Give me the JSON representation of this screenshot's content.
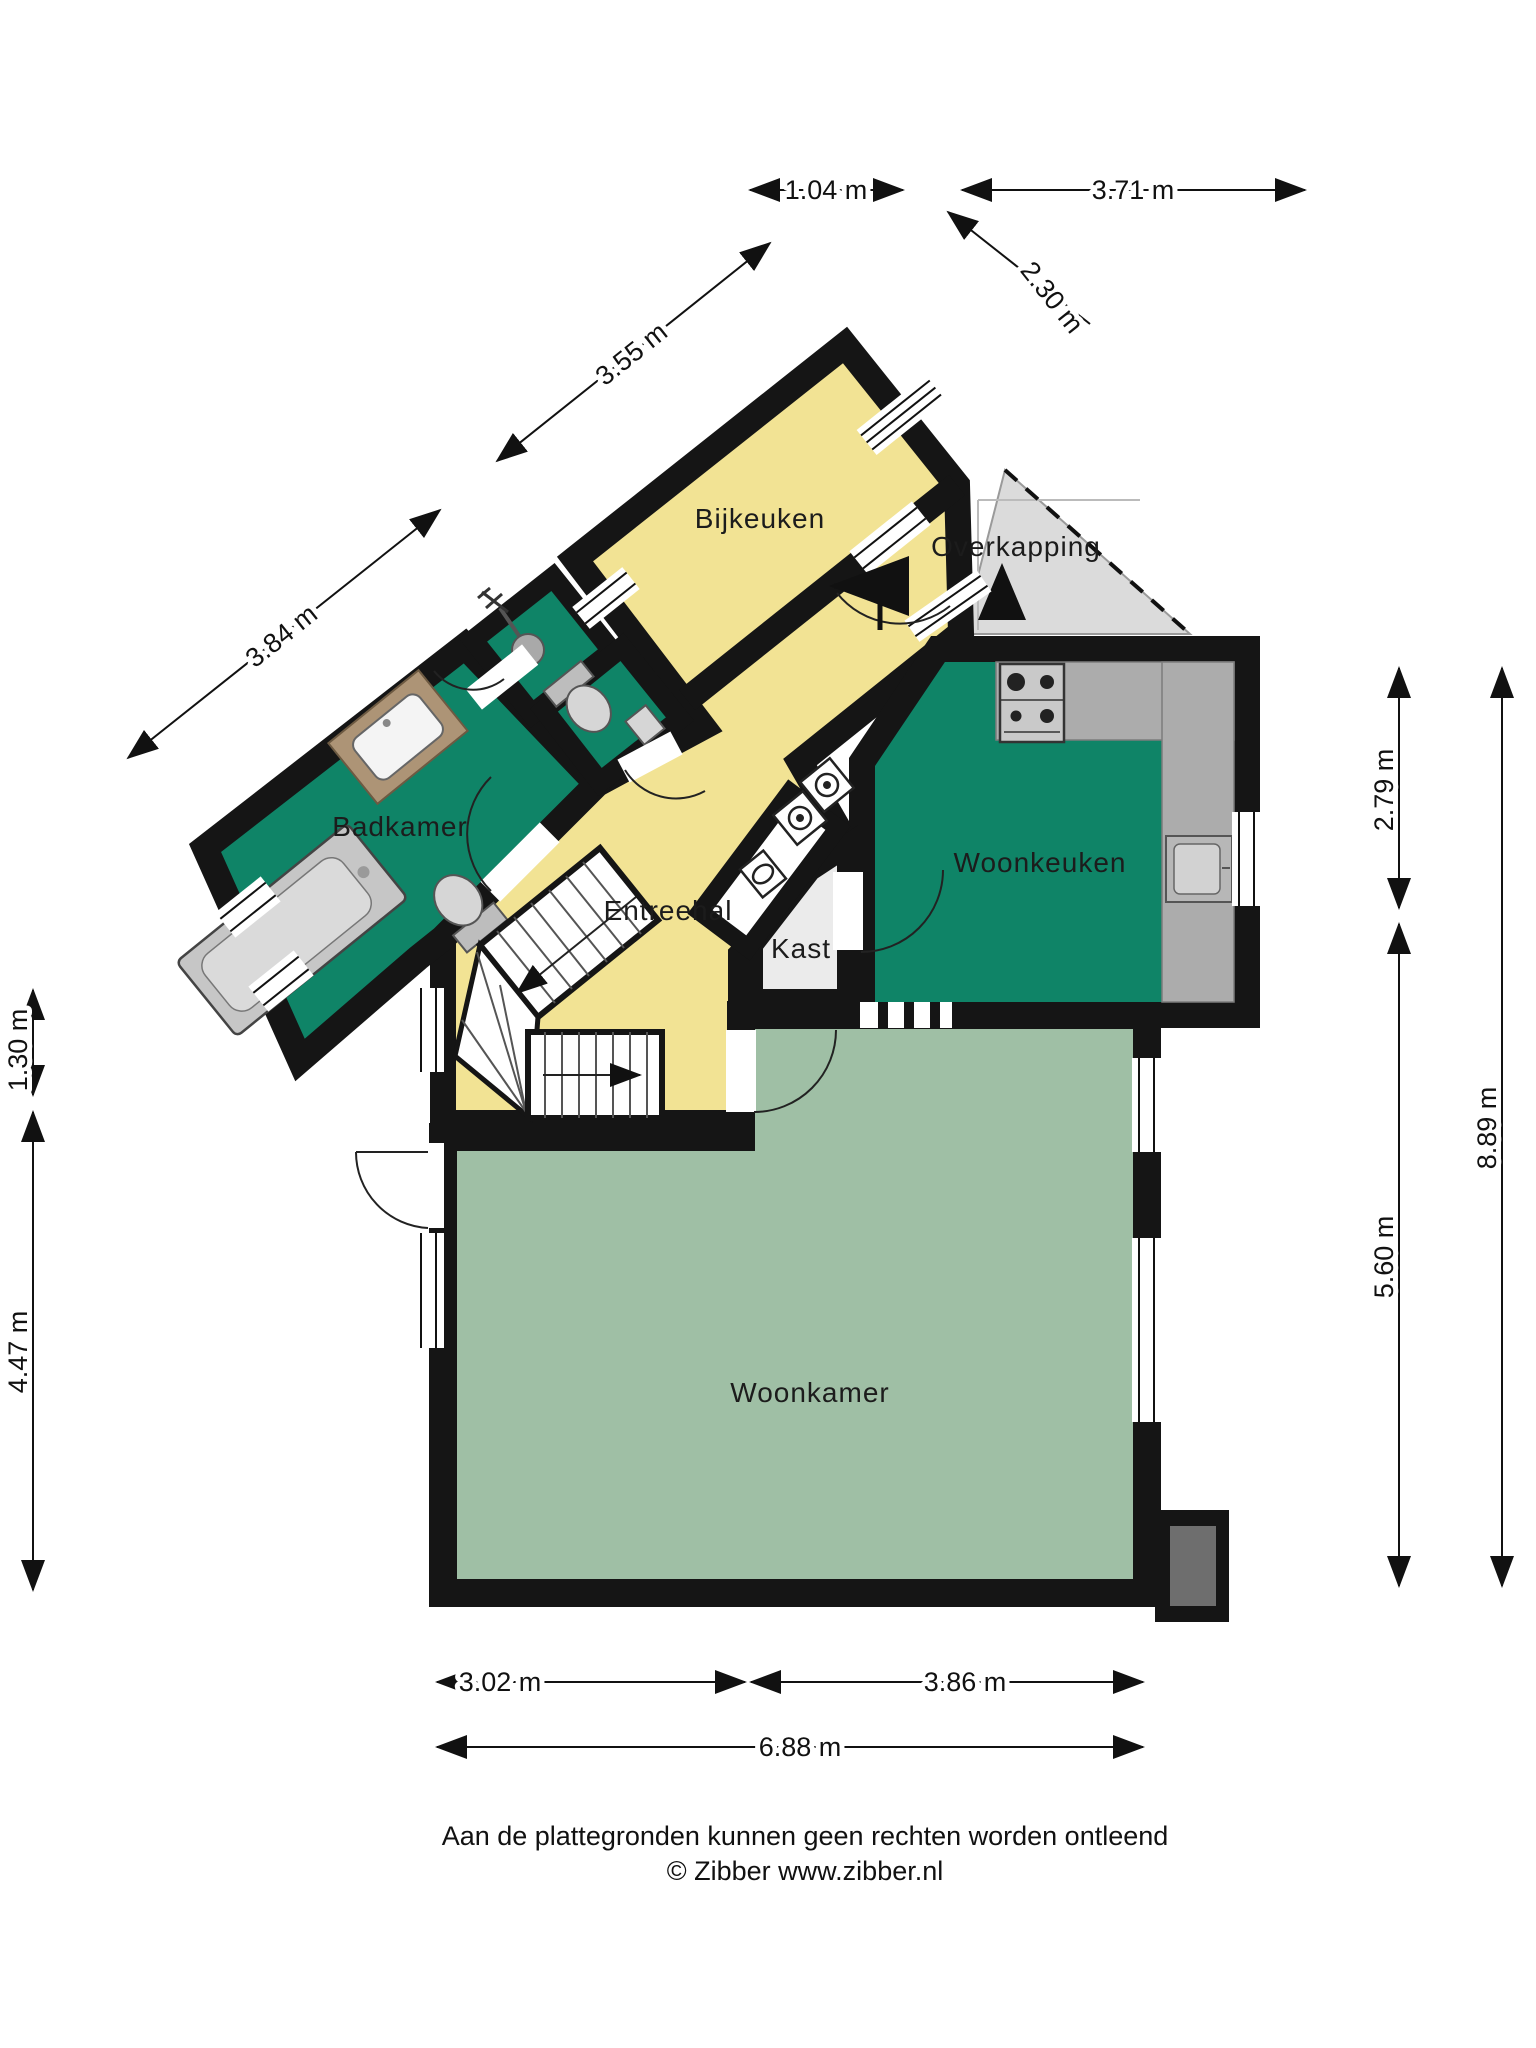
{
  "rooms": {
    "bijkeuken": "Bijkeuken",
    "overkapping": "Overkapping",
    "badkamer": "Badkamer",
    "entreehal": "Entreehal",
    "kast": "Kast",
    "woonkeuken": "Woonkeuken",
    "woonkamer": "Woonkamer"
  },
  "dimensions": {
    "top_small": "1.04 m",
    "top_wide": "3.71 m",
    "top_diagonal": "2.30 m",
    "upper_left_diagonal": "3.55 m",
    "lower_left_diagonal": "3.84 m",
    "left_upper": "1.30 m",
    "left_lower": "4.47 m",
    "right_inner_upper": "2.79 m",
    "right_inner_lower": "5.60 m",
    "right_outer": "8.89 m",
    "bottom_left": "3.02 m",
    "bottom_right": "3.86 m",
    "bottom_total": "6.88 m"
  },
  "footer": {
    "line1": "Aan de plattegronden kunnen geen rechten worden ontleend",
    "line2": "© Zibber www.zibber.nl"
  },
  "colors": {
    "yellow": "#F2E394",
    "green": "#0F8467",
    "sage": "#9FBFA5",
    "overkap": "#DBDBDB",
    "wall": "#151515",
    "counter": "#ACACAC"
  }
}
